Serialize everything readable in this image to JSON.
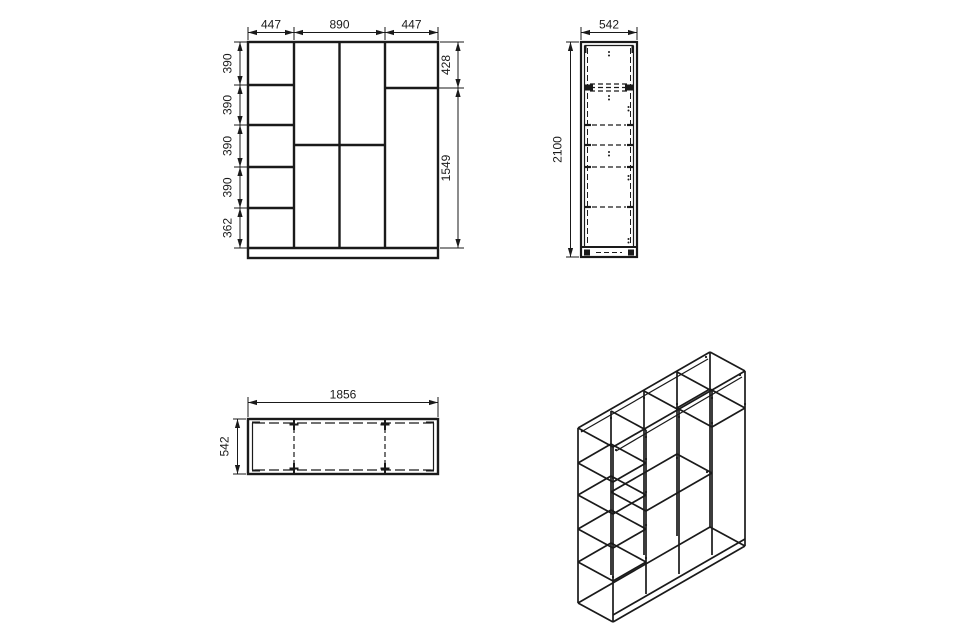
{
  "drawing": {
    "front_view": {
      "top_dims": [
        "447",
        "890",
        "447"
      ],
      "left_dims": [
        "390",
        "390",
        "390",
        "390",
        "362"
      ],
      "right_dims": [
        "428",
        "1549"
      ]
    },
    "side_view": {
      "depth_dim": "542",
      "height_dim": "2100"
    },
    "top_view": {
      "width_dim": "1856",
      "depth_dim": "542"
    }
  },
  "colors": {
    "line": "#1a1a1a",
    "background": "#ffffff"
  }
}
